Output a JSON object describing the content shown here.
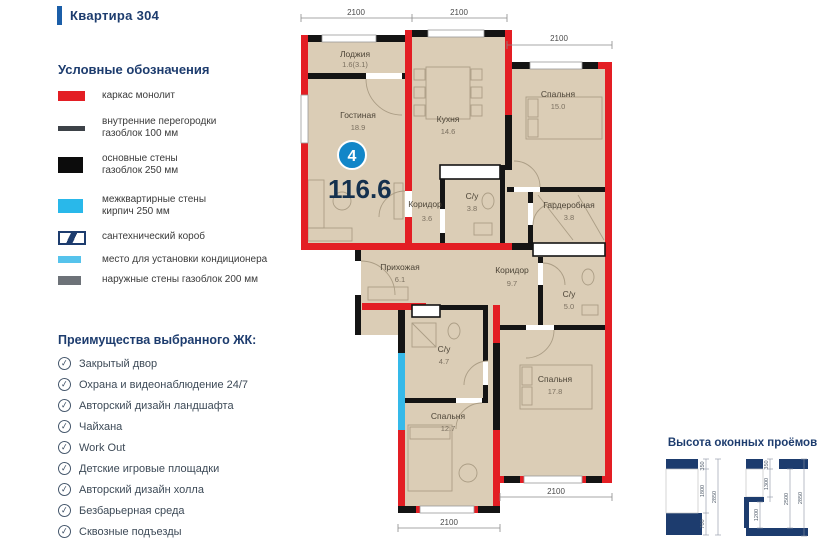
{
  "header": {
    "apartment_label": "Квартира 304"
  },
  "legend": {
    "title": "Условные обозначения",
    "items": [
      {
        "key": "monolith-frame",
        "label": "каркас монолит",
        "label2": ""
      },
      {
        "key": "partitions",
        "label": "внутренние перегородки",
        "label2": "газоблок 100 мм"
      },
      {
        "key": "main-walls",
        "label": "основные стены",
        "label2": "газоблок 250 мм"
      },
      {
        "key": "inter-apartment",
        "label": "межквартирные стены",
        "label2": "кирпич 250 мм"
      },
      {
        "key": "plumbing-duct",
        "label": "сантехнический короб",
        "label2": ""
      },
      {
        "key": "ac-place",
        "label": "место для установки кондиционера",
        "label2": ""
      },
      {
        "key": "outer-walls",
        "label": "наружные стены газоблок 200 мм",
        "label2": ""
      }
    ]
  },
  "advantages": {
    "title": "Преимущества выбранного ЖК:",
    "items": [
      "Закрытый двор",
      "Охрана и видеонаблюдение 24/7",
      "Авторский дизайн ландшафта",
      "Чайхана",
      "Work Out",
      "Детские игровые площадки",
      "Авторский дизайн холла",
      "Безбарьерная среда",
      "Сквозные подъезды"
    ]
  },
  "icons": {
    "check": "✓"
  },
  "plan": {
    "badge_number": "4",
    "total_area": "116.6",
    "rooms": [
      {
        "name": "Лоджия",
        "area": "1.6(3.1)"
      },
      {
        "name": "Гостиная",
        "area": "18.9"
      },
      {
        "name": "Кухня",
        "area": "14.6"
      },
      {
        "name": "Спальня",
        "area": "15.0"
      },
      {
        "name": "Гардеробная",
        "area": "3.8"
      },
      {
        "name": "С/у",
        "area": "3.8"
      },
      {
        "name": "Коридор",
        "area": "3.6"
      },
      {
        "name": "Прихожая",
        "area": "6.1"
      },
      {
        "name": "Коридор",
        "area": "9.7"
      },
      {
        "name": "С/у",
        "area": "5.0"
      },
      {
        "name": "С/у",
        "area": "4.7"
      },
      {
        "name": "Спальня",
        "area": "12.7"
      },
      {
        "name": "Спальня",
        "area": "17.8"
      }
    ],
    "dims": [
      "2100",
      "2100",
      "2100",
      "2100",
      "2100"
    ]
  },
  "window_heights": {
    "title": "Высота оконных проёмов",
    "left": {
      "values": [
        "350",
        "1800",
        "700",
        "2850"
      ]
    },
    "right": {
      "values": [
        "350",
        "1300",
        "1200",
        "2500",
        "2850"
      ]
    }
  },
  "colors": {
    "wall_red": "#e31e24",
    "wall_black": "#141414",
    "wall_cyan": "#35b9e9",
    "room_fill": "#dbcdb6",
    "navy": "#1d3c6e",
    "badge_blue": "#1286c8"
  }
}
